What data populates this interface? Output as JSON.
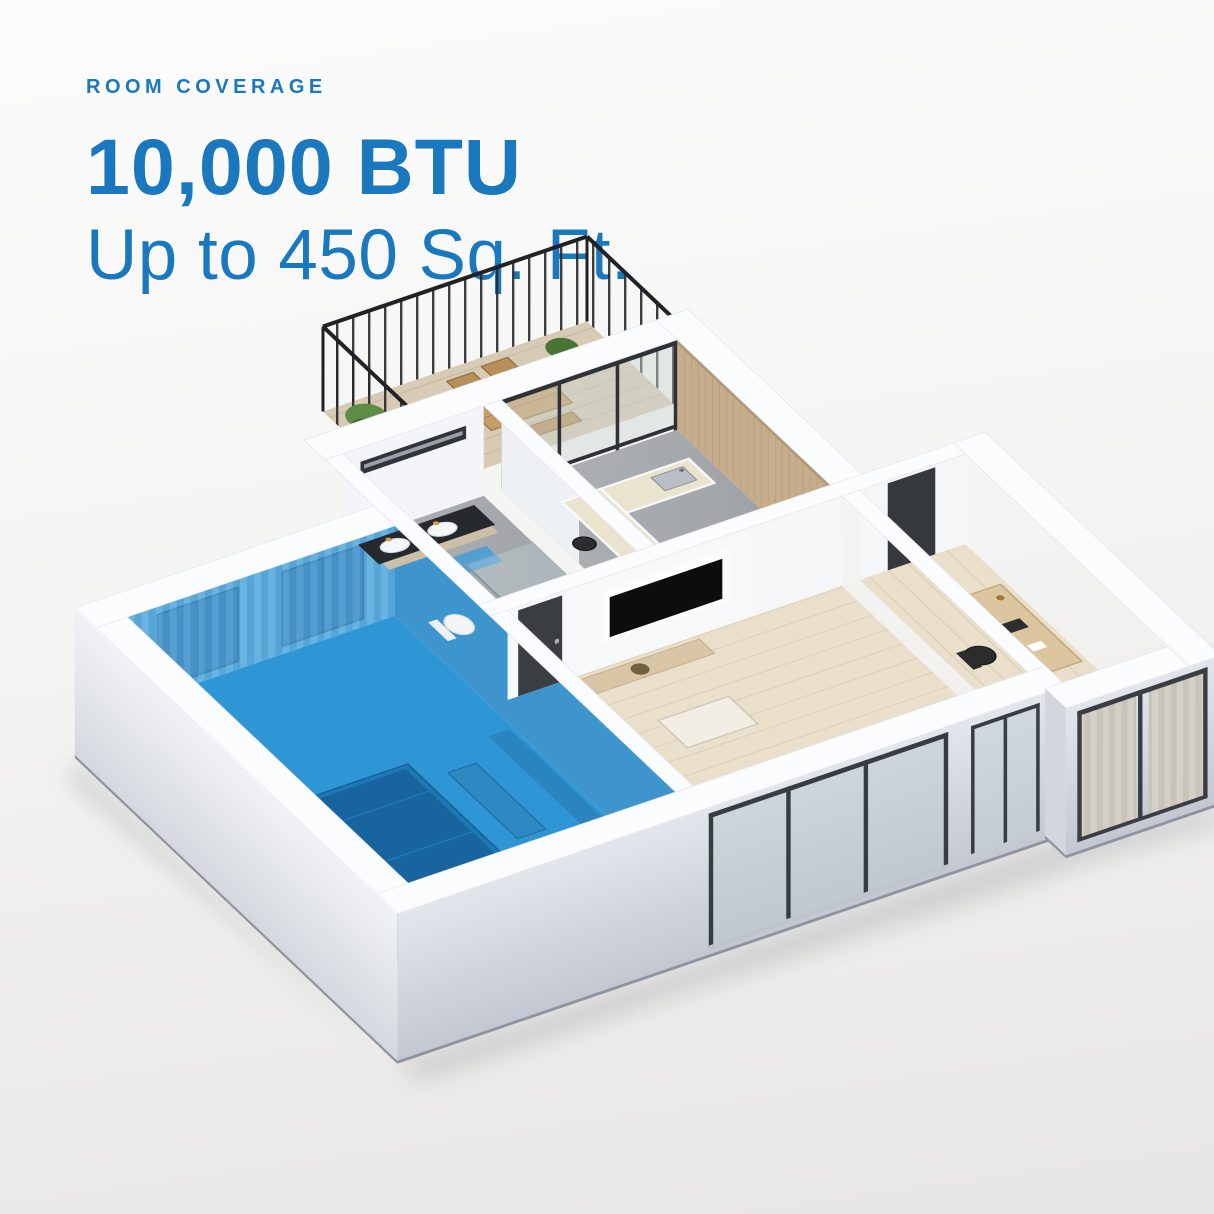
{
  "header": {
    "eyebrow": "ROOM COVERAGE",
    "headline": "10,000 BTU",
    "subheadline": "Up to 450 Sq. Ft."
  },
  "colors": {
    "accent_blue": "#1a78bf",
    "highlight_room_blue": "#2e96d5",
    "wall_white": "#fbfcfe",
    "wood_floor": "#e9dfca",
    "concrete_floor": "#a7abae",
    "balcony_deck": "#d8cbb5",
    "background_top": "#fcfcfc",
    "background_bottom": "#e7e6e4"
  },
  "floor_plan": {
    "type": "3d-isometric-apartment",
    "highlighted_room": "bedroom",
    "rooms": [
      "bedroom",
      "bathroom",
      "kitchen",
      "living-room",
      "hallway",
      "office",
      "balcony"
    ]
  }
}
